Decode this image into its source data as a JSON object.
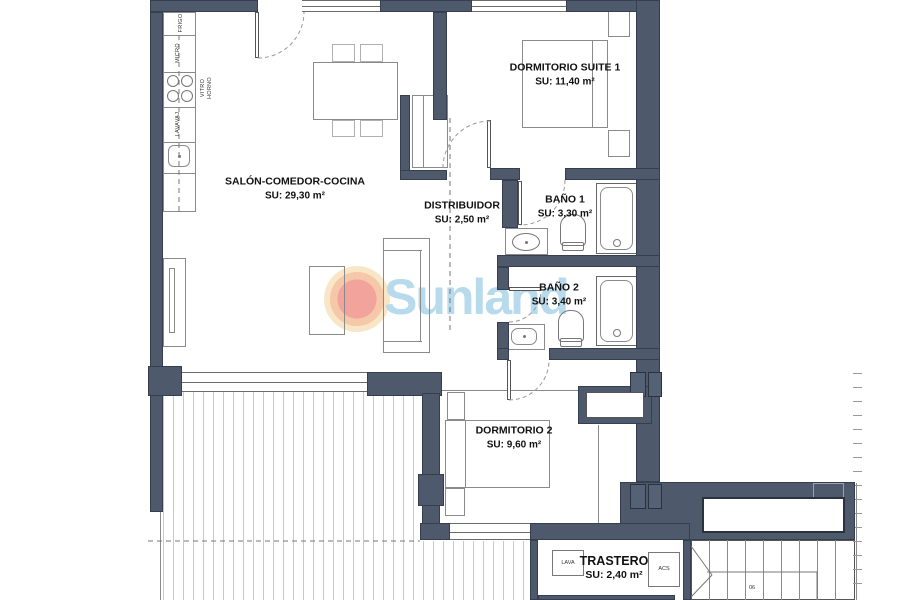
{
  "watermark": {
    "brand": "Sunland",
    "registered": "®",
    "text_color": "#b7daed",
    "sun_color": "#f1a39c",
    "halo_color": "#f9e6c7"
  },
  "colors": {
    "wall": "#4e5a6c",
    "furniture_line": "#8a8a8a"
  },
  "rooms": {
    "salon": {
      "name": "SALÓN-COMEDOR-COCINA",
      "area": "SU: 29,30 m²"
    },
    "suite": {
      "name": "DORMITORIO SUITE 1",
      "area": "SU: 11,40 m²"
    },
    "distribuidor": {
      "name": "DISTRIBUIDOR",
      "area": "SU: 2,50 m²"
    },
    "bano1": {
      "name": "BAÑO 1",
      "area": "SU: 3,30 m²"
    },
    "bano2": {
      "name": "BAÑO 2",
      "area": "SU: 3,40 m²"
    },
    "dorm2": {
      "name": "DORMITORIO 2",
      "area": "SU: 9,60 m²"
    },
    "trastero": {
      "name": "TRASTERO",
      "area": "SU: 2,40 m²"
    }
  },
  "appliances": {
    "fridge": "FRIGO",
    "micro": "MICRO",
    "hob_line1": "VITRO",
    "hob_line2": "HORNO",
    "dishwasher": "LAVAVAJ",
    "washer": "LAVA",
    "water_heater": "ACS"
  },
  "stairs": {
    "number": "06"
  }
}
